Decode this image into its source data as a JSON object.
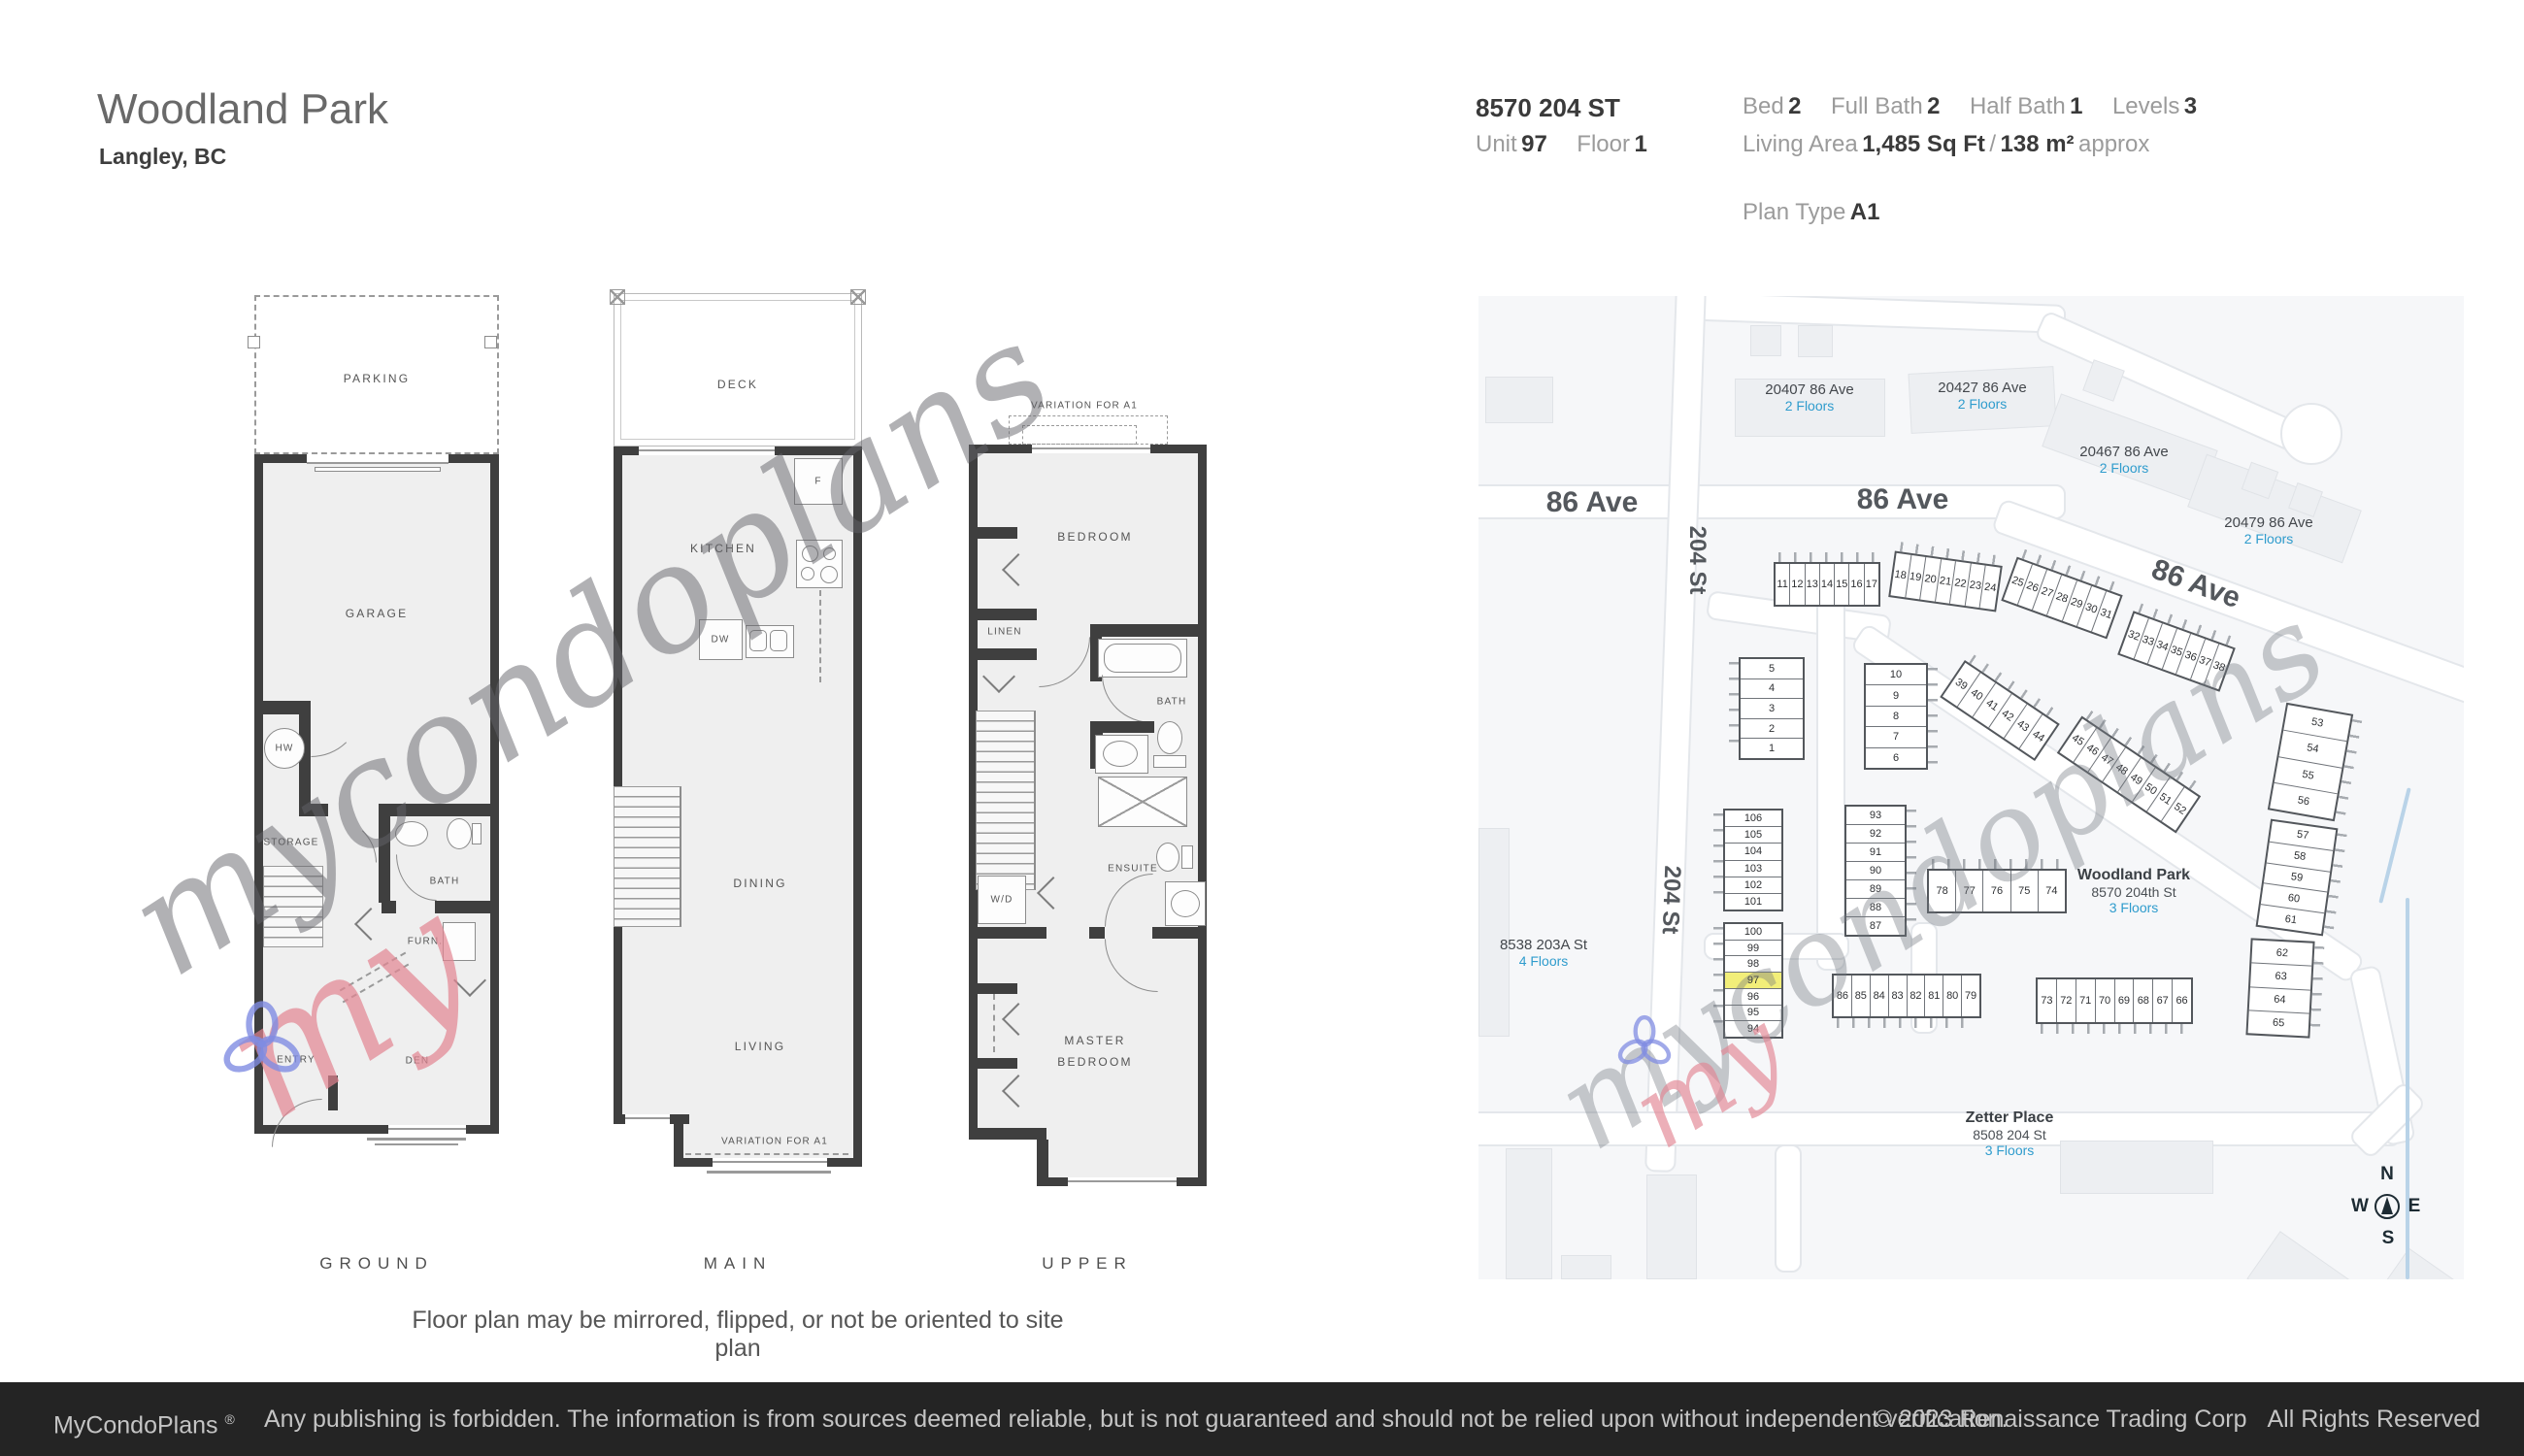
{
  "header": {
    "title": "Woodland Park",
    "subtitle": "Langley, BC"
  },
  "details": {
    "address": "8570 204 ST",
    "unit_label": "Unit",
    "unit_value": "97",
    "floor_label": "Floor",
    "floor_value": "1",
    "bed_label": "Bed",
    "bed_value": "2",
    "full_bath_label": "Full Bath",
    "full_bath_value": "2",
    "half_bath_label": "Half Bath",
    "half_bath_value": "1",
    "levels_label": "Levels",
    "levels_value": "3",
    "living_area_label": "Living Area",
    "living_area_value": "1,485 Sq Ft",
    "living_area_sep": "/",
    "living_area_metric": "138 m²",
    "living_area_suffix": "approx",
    "plan_type_label": "Plan Type",
    "plan_type_value": "A1"
  },
  "floorplans": {
    "note": "Floor plan may be mirrored, flipped, or not be oriented to site plan",
    "ground": {
      "caption": "GROUND",
      "parking": "PARKING",
      "garage": "GARAGE",
      "hw": "HW",
      "storage": "STORAGE",
      "bath": "BATH",
      "furn": "FURN.",
      "entry": "ENTRY",
      "den": "DEN"
    },
    "main": {
      "caption": "MAIN",
      "deck": "DECK",
      "kitchen": "KITCHEN",
      "fridge": "F",
      "dw": "DW",
      "dining": "DINING",
      "living": "LIVING",
      "variation": "VARIATION FOR A1"
    },
    "upper": {
      "caption": "UPPER",
      "variation": "VARIATION FOR A1",
      "bedroom": "BEDROOM",
      "linen": "LINEN",
      "bath": "BATH",
      "wd": "W/D",
      "ensuite": "ENSUITE",
      "master_line1": "MASTER",
      "master_line2": "BEDROOM"
    }
  },
  "watermark": {
    "script": "mycondoplans",
    "accent": "my"
  },
  "map": {
    "streets": {
      "ave86_left": "86 Ave",
      "ave86_mid": "86 Ave",
      "ave86_diag": "86 Ave",
      "st204_upper": "204 St",
      "st204_lower": "204 St"
    },
    "buildings": [
      {
        "name": "20407 86 Ave",
        "floors": "2 Floors"
      },
      {
        "name": "20427 86 Ave",
        "floors": "2 Floors"
      },
      {
        "name": "20467 86 Ave",
        "floors": "2 Floors"
      },
      {
        "name": "20479 86 Ave",
        "floors": "2 Floors"
      },
      {
        "name": "8538 203A St",
        "floors": "4 Floors"
      }
    ],
    "complex": {
      "name": "Woodland Park",
      "address": "8570 204th St",
      "floors": "3 Floors"
    },
    "zetter": {
      "name": "Zetter Place",
      "address": "8508 204 St",
      "floors": "3 Floors"
    },
    "highlight_unit": "97",
    "clusters": {
      "r11_17": [
        "11",
        "12",
        "13",
        "14",
        "15",
        "16",
        "17"
      ],
      "r18_24": [
        "18",
        "19",
        "20",
        "21",
        "22",
        "23",
        "24"
      ],
      "r25_31": [
        "25",
        "26",
        "27",
        "28",
        "29",
        "30",
        "31"
      ],
      "r32_38": [
        "32",
        "33",
        "34",
        "35",
        "36",
        "37",
        "38"
      ],
      "r39_44": [
        "39",
        "40",
        "41",
        "42",
        "43",
        "44"
      ],
      "r45_52": [
        "45",
        "46",
        "47",
        "48",
        "49",
        "50",
        "51",
        "52"
      ],
      "c5_1": [
        "5",
        "4",
        "3",
        "2",
        "1"
      ],
      "c10_6": [
        "10",
        "9",
        "8",
        "7",
        "6"
      ],
      "c106_101": [
        "106",
        "105",
        "104",
        "103",
        "102",
        "101"
      ],
      "c100_94": [
        "100",
        "99",
        "98",
        "97",
        "96",
        "95",
        "94"
      ],
      "c93_87": [
        "93",
        "92",
        "91",
        "90",
        "89",
        "88",
        "87"
      ],
      "r78_74": [
        "78",
        "77",
        "76",
        "75",
        "74"
      ],
      "r86_79": [
        "86",
        "85",
        "84",
        "83",
        "82",
        "81",
        "80",
        "79"
      ],
      "r73_66": [
        "73",
        "72",
        "71",
        "70",
        "69",
        "68",
        "67",
        "66"
      ],
      "c53_56": [
        "53",
        "54",
        "55",
        "56"
      ],
      "c57_61": [
        "57",
        "58",
        "59",
        "60",
        "61"
      ],
      "c62_65": [
        "62",
        "63",
        "64",
        "65"
      ]
    },
    "compass": {
      "n": "N",
      "e": "E",
      "s": "S",
      "w": "W"
    }
  },
  "footer": {
    "brand": "MyCondoPlans",
    "reg": "®",
    "disclaimer": "Any publishing is forbidden. The information is from sources deemed reliable, but is not guaranteed and should not be relied upon without independent verification.",
    "copyright": "© 2023 Renaissance Trading Corp",
    "rights": "All Rights Reserved"
  }
}
